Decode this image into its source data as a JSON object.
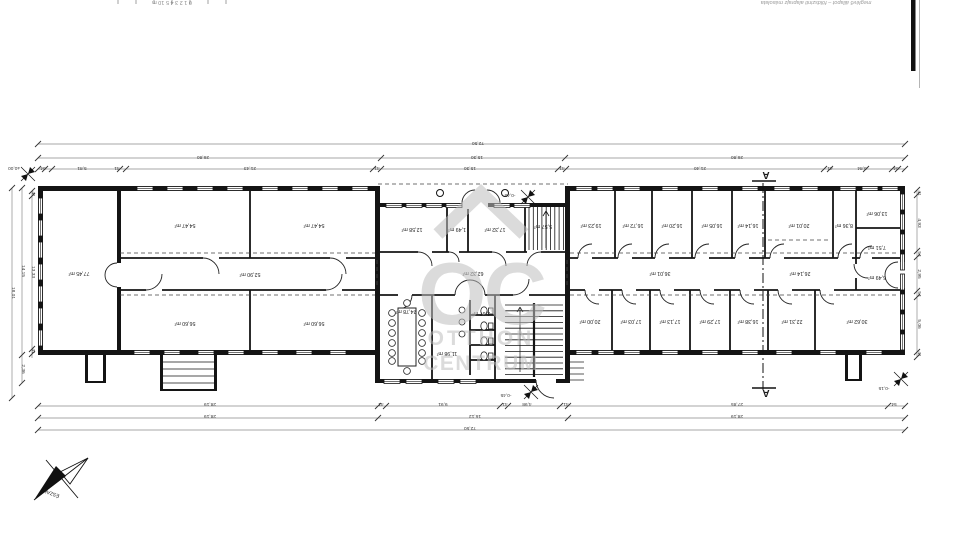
{
  "page": {
    "background": "#ffffff",
    "caption_top_right": "meglévő állapot – földszinti alaprajz másolata",
    "scale_ruler": "0  1  2  3  4  5   10 m"
  },
  "watermark": {
    "letters": "OC",
    "line1": "OTTHON",
    "line2": "CENTRUM",
    "color": "#bfbfbf"
  },
  "north": {
    "label": "ÉSZAK"
  },
  "section": {
    "label": "A"
  },
  "colors": {
    "wall": "#141414",
    "dim": "#3c3c3c",
    "dimline": "#8a8a8a",
    "caption": "#9a9a9a",
    "room_label": "#222222"
  },
  "rooms": [
    {
      "area": "77,45 m²",
      "x": 79,
      "y": 272
    },
    {
      "area": "54,47 m²",
      "x": 185,
      "y": 224
    },
    {
      "area": "54,47 m²",
      "x": 314,
      "y": 224
    },
    {
      "area": "52,90 m²",
      "x": 250,
      "y": 273
    },
    {
      "area": "56,60 m²",
      "x": 185,
      "y": 322
    },
    {
      "area": "56,60 m²",
      "x": 314,
      "y": 322
    },
    {
      "area": "12,58 m²",
      "x": 412,
      "y": 228
    },
    {
      "area": "1,49 m²",
      "x": 457,
      "y": 228
    },
    {
      "area": "17,32 m²",
      "x": 495,
      "y": 228
    },
    {
      "area": "5,57 m²",
      "x": 543,
      "y": 225
    },
    {
      "area": "62,32 m²",
      "x": 473,
      "y": 272
    },
    {
      "area": "24,78 m²",
      "x": 406,
      "y": 310
    },
    {
      "area": "2,67 m²",
      "x": 481,
      "y": 312
    },
    {
      "area": "11,98 m²",
      "x": 447,
      "y": 352
    },
    {
      "area": "19,23 m²",
      "x": 591,
      "y": 224
    },
    {
      "area": "16,72 m²",
      "x": 633,
      "y": 224
    },
    {
      "area": "16,20 m²",
      "x": 672,
      "y": 224
    },
    {
      "area": "16,05 m²",
      "x": 712,
      "y": 224
    },
    {
      "area": "16,14 m²",
      "x": 748,
      "y": 224
    },
    {
      "area": "20,01 m²",
      "x": 799,
      "y": 224
    },
    {
      "area": "8,36 m²",
      "x": 844,
      "y": 224
    },
    {
      "area": "13,06 m²",
      "x": 877,
      "y": 212
    },
    {
      "area": "7,51 m²",
      "x": 877,
      "y": 246
    },
    {
      "area": "36,01 m²",
      "x": 660,
      "y": 272
    },
    {
      "area": "26,14 m²",
      "x": 800,
      "y": 272
    },
    {
      "area": "6,49 m²",
      "x": 877,
      "y": 276
    },
    {
      "area": "20,00 m²",
      "x": 590,
      "y": 320
    },
    {
      "area": "17,03 m²",
      "x": 631,
      "y": 320
    },
    {
      "area": "17,13 m²",
      "x": 670,
      "y": 320
    },
    {
      "area": "17,29 m²",
      "x": 710,
      "y": 320
    },
    {
      "area": "16,38 m²",
      "x": 748,
      "y": 320
    },
    {
      "area": "22,31 m²",
      "x": 792,
      "y": 320
    },
    {
      "area": "30,62 m²",
      "x": 857,
      "y": 320
    }
  ],
  "dimensions": {
    "top": [
      {
        "t": "72,50",
        "x": 478,
        "y": 142
      },
      {
        "t": "26,80",
        "x": 203,
        "y": 156
      },
      {
        "t": "15,30",
        "x": 477,
        "y": 156
      },
      {
        "t": "26,80",
        "x": 737,
        "y": 156
      },
      {
        "t": "54",
        "x": 43,
        "y": 167
      },
      {
        "t": "5,81",
        "x": 82,
        "y": 167
      },
      {
        "t": "41",
        "x": 117,
        "y": 167
      },
      {
        "t": "21,43",
        "x": 250,
        "y": 167
      },
      {
        "t": "41",
        "x": 377,
        "y": 167
      },
      {
        "t": "15,30",
        "x": 470,
        "y": 167
      },
      {
        "t": "41",
        "x": 562,
        "y": 167
      },
      {
        "t": "21,40",
        "x": 700,
        "y": 167
      },
      {
        "t": "41",
        "x": 830,
        "y": 167
      },
      {
        "t": "5,84",
        "x": 862,
        "y": 167
      },
      {
        "t": "54",
        "x": 896,
        "y": 167
      }
    ],
    "bottom": [
      {
        "t": "28,19",
        "x": 210,
        "y": 403
      },
      {
        "t": "41",
        "x": 381,
        "y": 403
      },
      {
        "t": "9,91",
        "x": 443,
        "y": 403
      },
      {
        "t": "41",
        "x": 505,
        "y": 403
      },
      {
        "t": "4,98",
        "x": 527,
        "y": 403
      },
      {
        "t": "41",
        "x": 566,
        "y": 403
      },
      {
        "t": "27,85",
        "x": 737,
        "y": 403
      },
      {
        "t": "54",
        "x": 894,
        "y": 403
      },
      {
        "t": "28,19",
        "x": 210,
        "y": 415
      },
      {
        "t": "16,12",
        "x": 475,
        "y": 415
      },
      {
        "t": "28,19",
        "x": 737,
        "y": 415
      },
      {
        "t": "72,50",
        "x": 470,
        "y": 427
      }
    ],
    "left": [
      {
        "t": "18,01",
        "x": 12,
        "y": 293,
        "rot": 90
      },
      {
        "t": "14,15",
        "x": 22,
        "y": 271,
        "rot": 90
      },
      {
        "t": "2,36",
        "x": 22,
        "y": 369,
        "rot": 90
      },
      {
        "t": "41",
        "x": 32,
        "y": 194,
        "rot": 90
      },
      {
        "t": "13,33",
        "x": 32,
        "y": 272,
        "rot": 90
      },
      {
        "t": "41",
        "x": 32,
        "y": 351,
        "rot": 90
      }
    ],
    "right": [
      {
        "t": "41",
        "x": 918,
        "y": 193,
        "rot": 90
      },
      {
        "t": "4,93",
        "x": 918,
        "y": 223,
        "rot": 90
      },
      {
        "t": "54",
        "x": 918,
        "y": 254,
        "rot": 90
      },
      {
        "t": "2,95",
        "x": 918,
        "y": 274,
        "rot": 90
      },
      {
        "t": "54",
        "x": 918,
        "y": 294,
        "rot": 90
      },
      {
        "t": "5,06",
        "x": 918,
        "y": 324,
        "rot": 90
      },
      {
        "t": "41",
        "x": 918,
        "y": 354,
        "rot": 90
      }
    ]
  },
  "elevations": [
    {
      "value": "±0,00",
      "mx": 28,
      "my": 174,
      "tx": 14,
      "ty": 167
    },
    {
      "value": "-0,45",
      "mx": 528,
      "my": 197,
      "tx": 510,
      "ty": 194
    },
    {
      "value": "-0,45",
      "mx": 531,
      "my": 392,
      "tx": 506,
      "ty": 394
    },
    {
      "value": "-0,15",
      "mx": 901,
      "my": 379,
      "tx": 884,
      "ty": 387
    }
  ]
}
